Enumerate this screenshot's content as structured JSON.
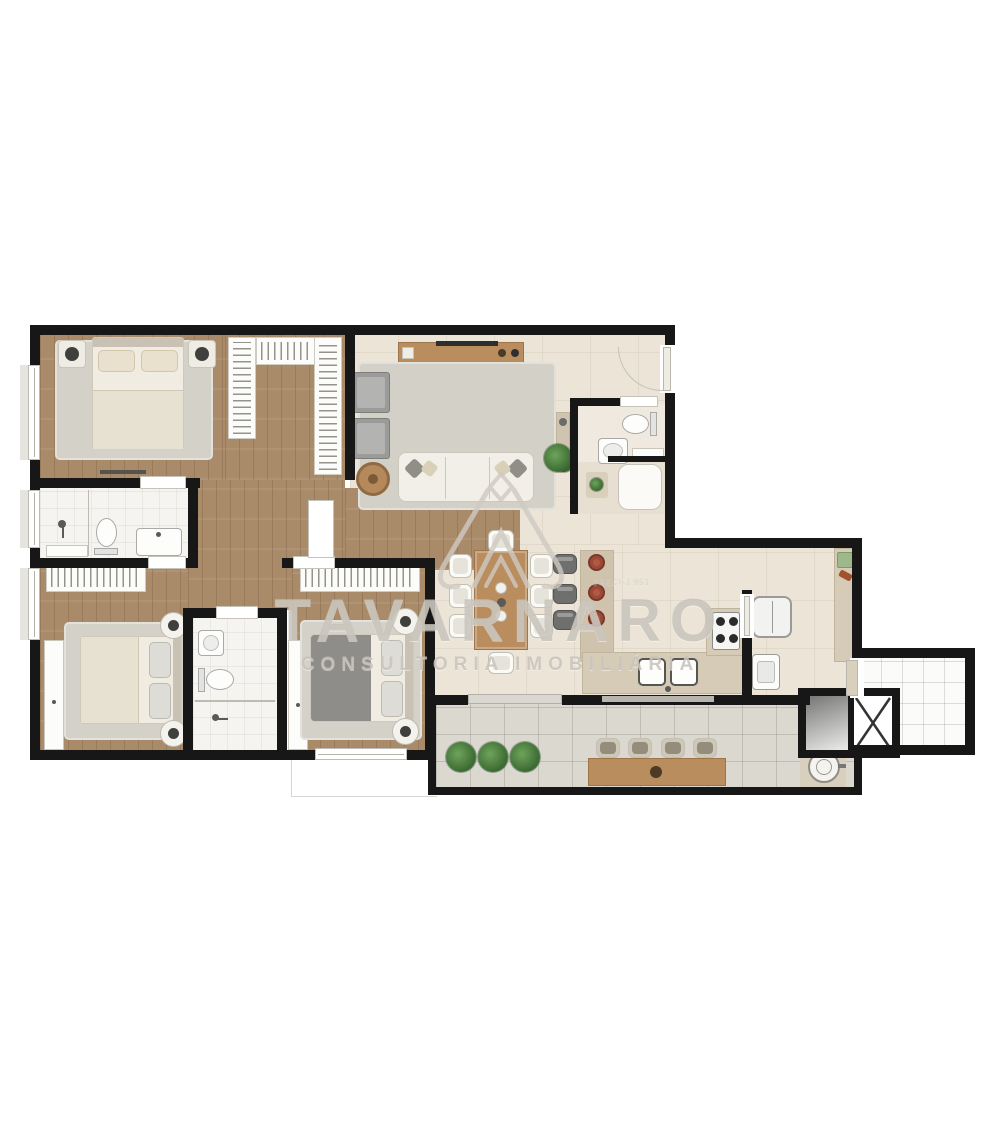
{
  "watermark": {
    "brand": "TAVARNARO",
    "tagline": "CONSULTORIA IMOBILIÁRIA",
    "registry": "CRECI-J 951",
    "logo": "roof-peak-logo",
    "color": "#c4bfb7"
  },
  "palette": {
    "wall": "#171717",
    "wood_floor": "#aa8b69",
    "cream_floor": "#ece5d7",
    "bath_floor": "#f5f4f0",
    "terrace_floor": "#dbd8d0",
    "hall_floor": "#fbfbf9",
    "rug": "#d4d1c9",
    "wood_furniture": "#b98d5e",
    "counter": "#d6cbb6",
    "plant_green": "#4c7d3e",
    "accent_red": "#9c4a38"
  },
  "rooms": [
    {
      "id": "bedroom-1",
      "furniture": [
        "double-bed",
        "nightstand-left",
        "nightstand-right",
        "rug",
        "window"
      ]
    },
    {
      "id": "walk-in-closet",
      "furniture": [
        "wardrobe-left",
        "wardrobe-top",
        "wardrobe-right"
      ]
    },
    {
      "id": "bathroom-1",
      "furniture": [
        "shower",
        "toilet",
        "sink-counter",
        "towel-shelf",
        "window"
      ]
    },
    {
      "id": "bedroom-2",
      "furniture": [
        "wardrobe",
        "closet-column",
        "double-bed",
        "nightstand-top",
        "nightstand-bottom",
        "rug",
        "window"
      ]
    },
    {
      "id": "bathroom-2",
      "furniture": [
        "sink",
        "toilet",
        "shower"
      ]
    },
    {
      "id": "bedroom-3",
      "furniture": [
        "wardrobe",
        "closet-column",
        "double-bed",
        "nightstand-top",
        "nightstand-bottom",
        "rug",
        "window"
      ]
    },
    {
      "id": "living-room",
      "furniture": [
        "tv-sideboard",
        "tv",
        "rug",
        "armchair-1",
        "armchair-2",
        "coffee-table",
        "sofa",
        "plant",
        "console-table"
      ]
    },
    {
      "id": "lavabo",
      "furniture": [
        "toilet",
        "sink",
        "niche",
        "shower-box",
        "bath-mat"
      ]
    },
    {
      "id": "dining-area",
      "furniture": [
        "dining-table",
        "eight-chairs",
        "centerpiece"
      ]
    },
    {
      "id": "kitchen",
      "furniture": [
        "bar-counter",
        "three-bar-stools",
        "three-plates",
        "sink-counter",
        "double-sink",
        "cooktop"
      ]
    },
    {
      "id": "service-area",
      "furniture": [
        "refrigerator",
        "laundry-tank",
        "side-counter"
      ]
    },
    {
      "id": "terrace",
      "furniture": [
        "three-plants",
        "wood-table",
        "four-chairs",
        "barbecue-sink",
        "glass-railing"
      ]
    },
    {
      "id": "common-hall",
      "furniture": [
        "elevator",
        "stairs-shaft"
      ]
    }
  ]
}
